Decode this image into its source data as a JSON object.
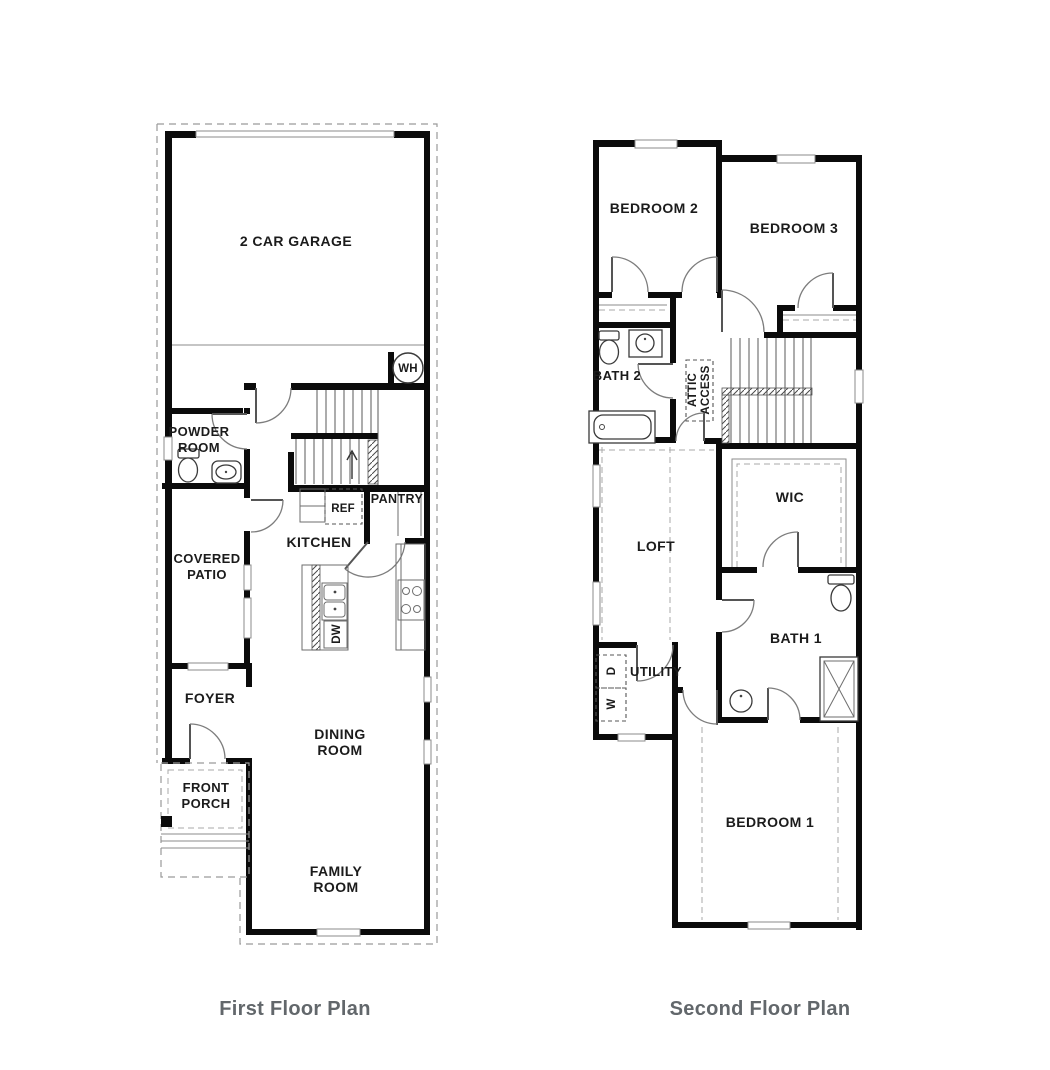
{
  "page": {
    "background": "#ffffff",
    "wall_color": "#0b0b0b",
    "caption_color": "#62676b"
  },
  "captions": {
    "first": "First Floor Plan",
    "second": "Second Floor Plan"
  },
  "first": {
    "labels": {
      "garage": "2 CAR GARAGE",
      "wh": "WH",
      "powder1": "POWDER",
      "powder2": "ROOM",
      "patio1": "COVERED",
      "patio2": "PATIO",
      "kitchen": "KITCHEN",
      "ref": "REF",
      "pantry": "PANTRY",
      "dw": "DW",
      "foyer": "FOYER",
      "dining1": "DINING",
      "dining2": "ROOM",
      "porch1": "FRONT",
      "porch2": "PORCH",
      "family1": "FAMILY",
      "family2": "ROOM"
    }
  },
  "second": {
    "labels": {
      "bedroom2": "BEDROOM 2",
      "bedroom3": "BEDROOM 3",
      "bath2": "BATH 2",
      "attic1": "ATTIC",
      "attic2": "ACCESS",
      "loft": "LOFT",
      "wic": "WIC",
      "bath1": "BATH 1",
      "utility": "UTILITY",
      "dryer": "D",
      "washer": "W",
      "bedroom1": "BEDROOM 1"
    }
  }
}
